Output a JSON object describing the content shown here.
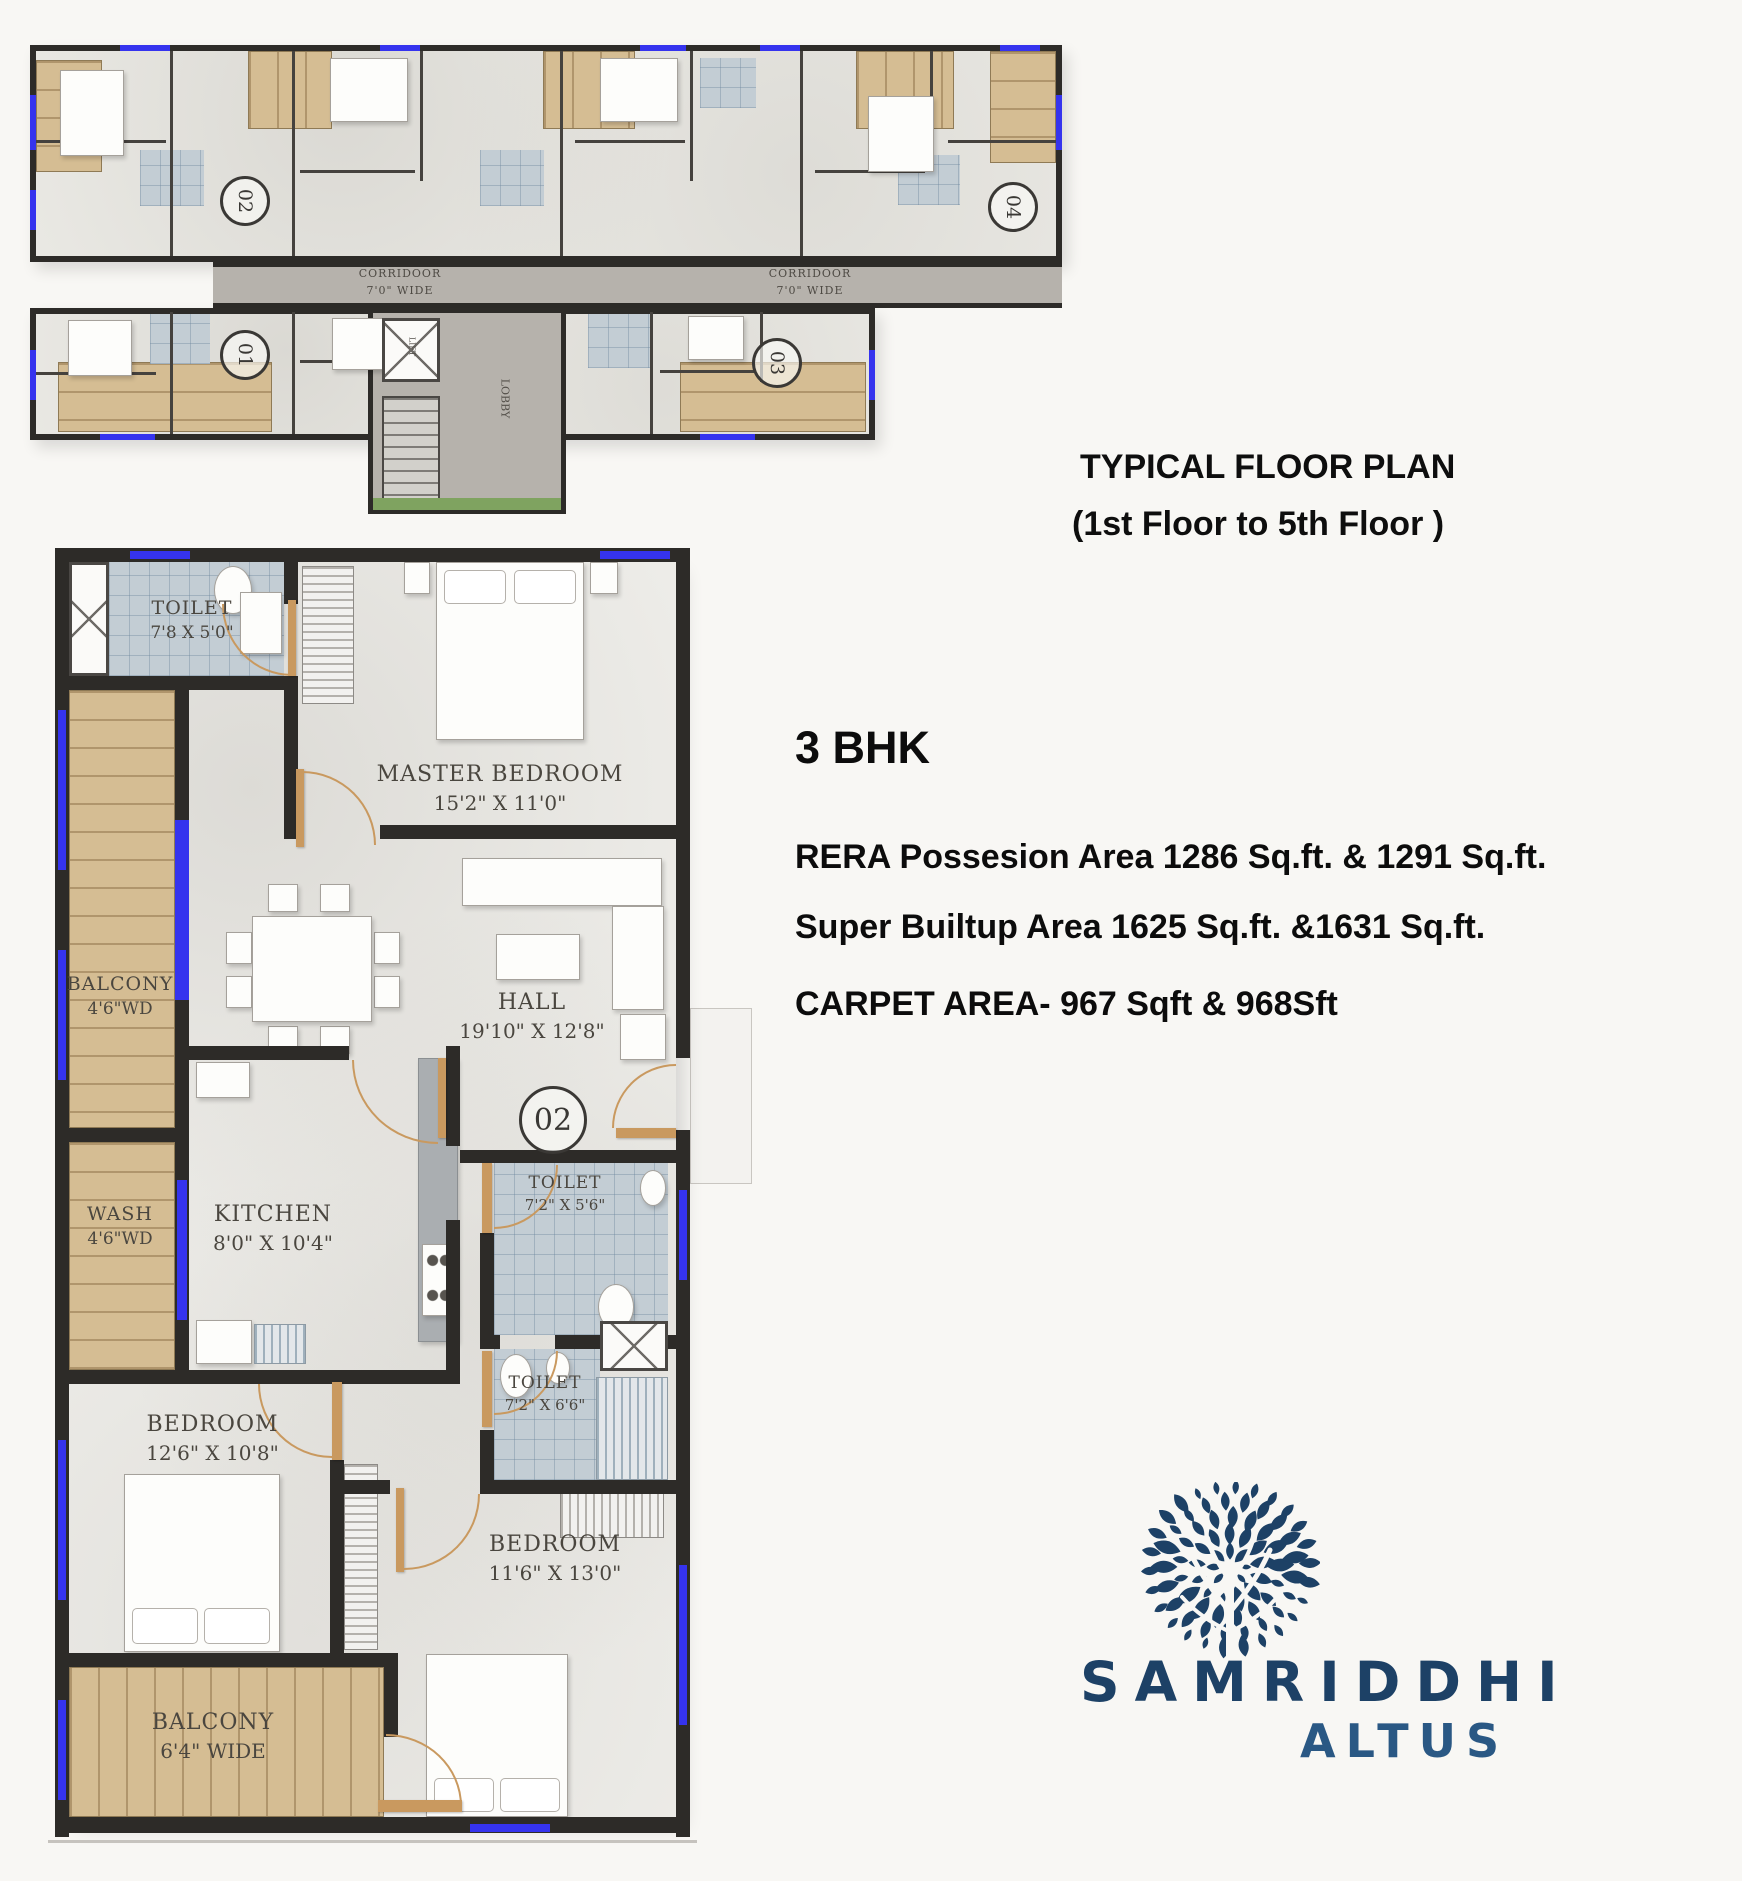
{
  "page": {
    "background": "#f8f7f4"
  },
  "typical_plan": {
    "title_line1": "TYPICAL FLOOR PLAN",
    "title_line2": "(1st Floor to 5th Floor )",
    "corridor_label": "CORRIDOOR",
    "corridor_width": "7'0\" WIDE",
    "lobby_label": "LOBBY",
    "lift_label": "LIFT",
    "units": [
      {
        "no": "01"
      },
      {
        "no": "02"
      },
      {
        "no": "03"
      },
      {
        "no": "04"
      }
    ]
  },
  "unit_plan": {
    "unit_number": "02",
    "rooms": [
      {
        "name": "TOILET",
        "dim": "7'8 X 5'0\""
      },
      {
        "name": "MASTER BEDROOM",
        "dim": "15'2\" X 11'0\""
      },
      {
        "name": "BALCONY",
        "dim": "4'6\"WD"
      },
      {
        "name": "HALL",
        "dim": "19'10\" X 12'8\""
      },
      {
        "name": "WASH",
        "dim": "4'6\"WD"
      },
      {
        "name": "KITCHEN",
        "dim": "8'0\" X 10'4\""
      },
      {
        "name": "TOILET",
        "dim": "7'2\" X 5'6\""
      },
      {
        "name": "TOILET",
        "dim": "7'2\" X 6'6\""
      },
      {
        "name": "BEDROOM",
        "dim": "12'6\" X 10'8\""
      },
      {
        "name": "BEDROOM",
        "dim": "11'6\" X 13'0\""
      },
      {
        "name": "BALCONY",
        "dim": "6'4\" WIDE"
      }
    ]
  },
  "details": {
    "bhk": "3 BHK",
    "rera": "RERA Possesion Area 1286 Sq.ft. & 1291 Sq.ft.",
    "super_builtup": "Super Builtup Area 1625 Sq.ft. &1631 Sq.ft.",
    "carpet": "CARPET AREA- 967 Sqft  & 968Sft"
  },
  "logo": {
    "brand": "SAMRIDDHI",
    "sub": "ALTUS",
    "primary_color": "#1d4166",
    "secondary_color": "#2a5884"
  },
  "colors": {
    "wall": "#2d2b28",
    "wood": "#d5bd93",
    "tile": "#c3cdd4",
    "corridor": "#b6b2ac",
    "window_blue": "#3533ee",
    "door_tan": "#c9995f"
  }
}
